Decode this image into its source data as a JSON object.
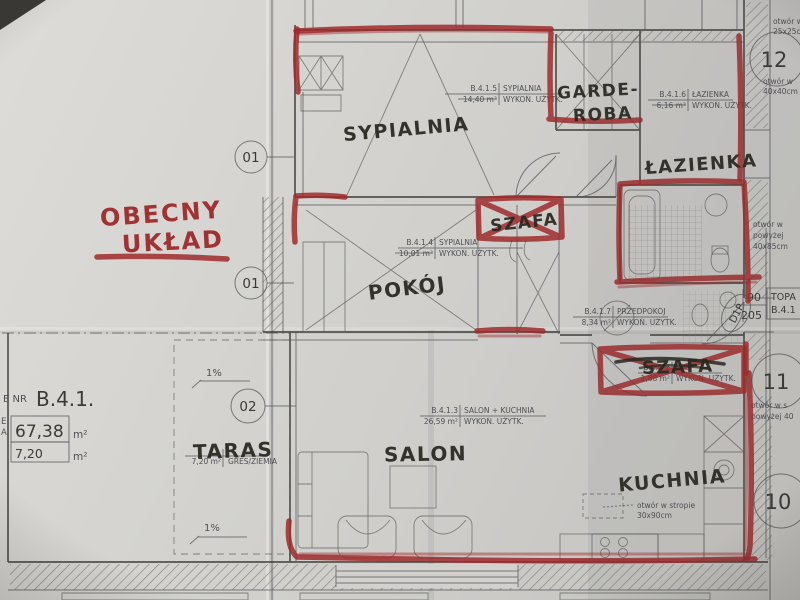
{
  "annotation": {
    "line1": "OBECNY",
    "line2": "UKŁAD"
  },
  "handwritten": {
    "sypialnia": "SYPIALNIA",
    "garderoba_l1": "GARDE-",
    "garderoba_l2": "ROBA",
    "lazienka": "ŁAZIENKA",
    "szafa_center": "SZAFA",
    "pokoj": "POKÓJ",
    "szafa_crossed": "SZAFA",
    "taras": "TARAS",
    "salon": "SALON",
    "kuchnia": "KUCHNIA"
  },
  "tables": {
    "t5": {
      "id": "B.4.1.5",
      "name": "SYPIALNIA",
      "area": "14,40 m²",
      "finish": "WYKOŃ. UŻYTK."
    },
    "t6": {
      "id": "B.4.1.6",
      "name": "ŁAZIENKA",
      "area": "6,16 m²",
      "finish": "WYKOŃ. UŻYTK."
    },
    "t4": {
      "id": "B.4.1.4",
      "name": "SYPIALNIA",
      "area": "10,01 m²",
      "finish": "WYKOŃ. UŻYTK."
    },
    "t7": {
      "id": "B.4.1.7",
      "name": "PRZEDPOKÓJ",
      "area": "8,34 m²",
      "finish": "WYKOŃ. UŻYTK."
    },
    "t2": {
      "id": "B.4.1.2",
      "name": "WC",
      "area": "1,88 m²",
      "finish": "WYKOŃ. UŻYTK."
    },
    "t3": {
      "id": "B.4.1.3",
      "name": "SALON + KUCHNIA",
      "area": "26,59 m²",
      "finish": "WYKOŃ. UŻYTK."
    },
    "t8": {
      "area": "7,20 m²",
      "finish": "GRES/ZIEMIA"
    }
  },
  "apartment": {
    "prefix": "E NR",
    "code": "B.4.1.",
    "total_area": "67,38",
    "terrace_area": "7,20",
    "unit": "m²",
    "frag1": "E",
    "frag2": "A"
  },
  "bubbles": {
    "b01a": "01",
    "b01b": "01",
    "b02": "02",
    "b12": "12",
    "b11": "11",
    "b10": "10"
  },
  "door": {
    "code": "D1P",
    "width": "90",
    "height": "205"
  },
  "side_box": {
    "l1": "TOPA",
    "l2": "B.4.1"
  },
  "notes": {
    "top_l1": "otwór w",
    "top_l2": "25x25cm",
    "mid_l1": "otwór w",
    "mid_l2": "40x40cm",
    "n12_l1": "otwór w",
    "n12_l2": "powyżej",
    "n12_l3": "40x85cm",
    "n11_l1": "otwór w s",
    "n11_l2": "powyżej 40",
    "kitchen_l1": "otwór w stropie",
    "kitchen_l2": "30x90cm",
    "slope": "1%"
  },
  "colors": {
    "red_marker": "#9f2a2c",
    "black_marker": "#26261f",
    "print_ink": "#55565a",
    "paper": "#d6d5d1"
  }
}
